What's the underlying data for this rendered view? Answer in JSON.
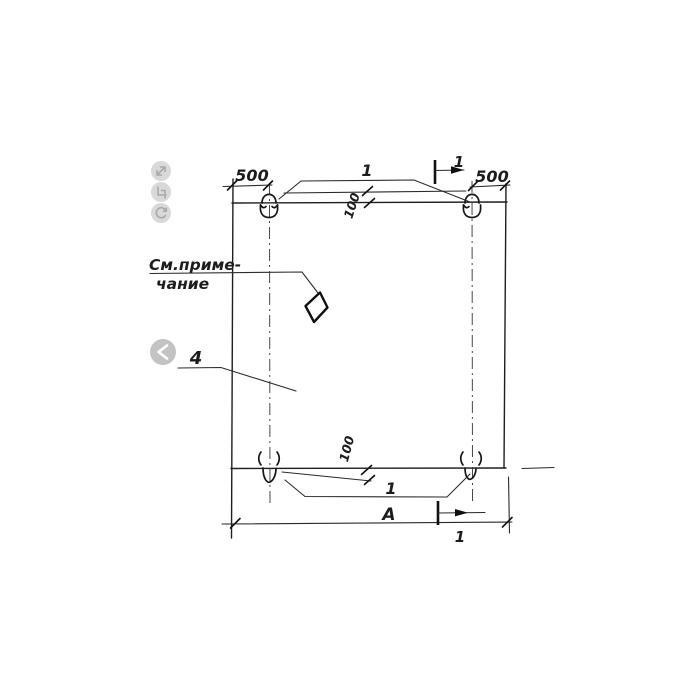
{
  "viewer": {
    "toolbar": {
      "expand": "expand",
      "crop": "crop",
      "rotate": "rotate"
    },
    "prev": "previous"
  },
  "drawing": {
    "labels": {
      "dim_500_left": "500",
      "dim_500_right": "500",
      "dim_100_top": "100",
      "dim_100_bottom": "100",
      "dim_width": "А",
      "callout_top": "1",
      "callout_bottom": "1",
      "section_mark_top": "1",
      "section_mark_bottom": "1",
      "note_line1": "См.приме-",
      "note_line2": "чание",
      "part_number": "4"
    },
    "colors": {
      "ink": "#1c1c1c",
      "paper": "#ffffff",
      "icon_gray": "#d9d9d9",
      "chevron_gray": "#c3c3c3"
    }
  }
}
